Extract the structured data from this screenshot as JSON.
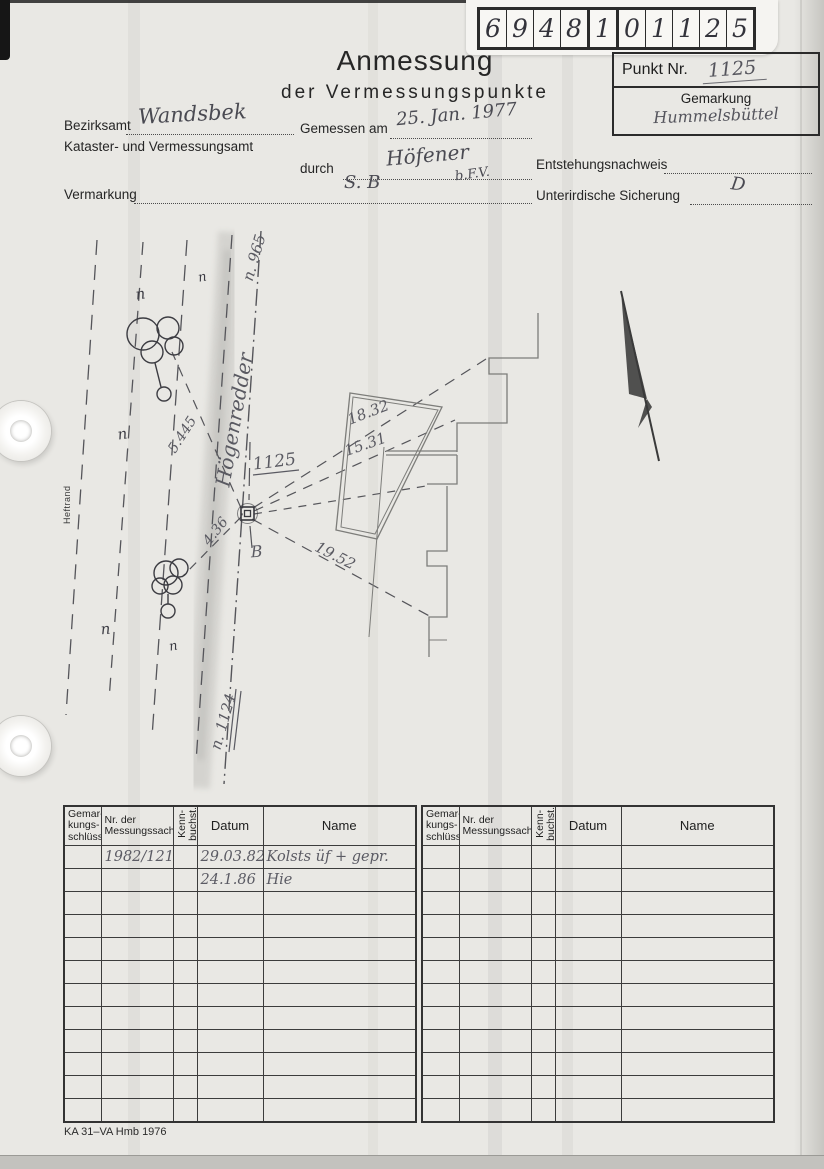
{
  "header": {
    "code_digits": [
      "6",
      "9",
      "4",
      "8",
      "1",
      "0",
      "1",
      "1",
      "2",
      "5"
    ],
    "punkt_label": "Punkt Nr.",
    "punkt_value": "1125",
    "gemarkung_label": "Gemarkung",
    "gemarkung_value": "Hummelsbüttel",
    "title": "Anmessung",
    "subtitle": "der Vermessungspunkte"
  },
  "form": {
    "bezirksamt_label": "Bezirksamt",
    "bezirksamt_value": "Wandsbek",
    "amt_label": "Kataster- und Vermessungsamt",
    "gemessen_label": "Gemessen am",
    "gemessen_value": "25. Jan. 1977",
    "durch_label": "durch",
    "durch_value": "Höfener",
    "durch_value2": "b.F.V.",
    "entstehung_label": "Entstehungsnachweis",
    "vermarkung_label": "Vermarkung",
    "vermarkung_value": "S. B",
    "sicherung_label": "Unterirdische Sicherung",
    "sicherung_value": "D"
  },
  "margin": {
    "heftrand": "Heftrand"
  },
  "sketch": {
    "street_name": "Högenredder",
    "point_number": "1125",
    "labels": [
      {
        "text": "Högenredder",
        "x": 241,
        "y": 421,
        "rot": -80,
        "size": 20,
        "cls": "pencil"
      },
      {
        "text": "n. 965",
        "x": 259,
        "y": 259,
        "rot": -74,
        "size": 15,
        "cls": "pencil"
      },
      {
        "text": "n. 1124",
        "x": 228,
        "y": 723,
        "rot": -74,
        "size": 15,
        "cls": "pencil"
      },
      {
        "text": "1125",
        "x": 275,
        "y": 467,
        "rot": -7,
        "size": 17,
        "cls": "pencil"
      },
      {
        "text": "B",
        "x": 257,
        "y": 557,
        "rot": -4,
        "size": 16,
        "cls": "pencil"
      },
      {
        "text": "5.445",
        "x": 186,
        "y": 437,
        "rot": -57,
        "size": 14,
        "cls": "pencil"
      },
      {
        "text": "4.36",
        "x": 219,
        "y": 534,
        "rot": -52,
        "size": 14,
        "cls": "pencil"
      },
      {
        "text": "19.52",
        "x": 333,
        "y": 560,
        "rot": 27,
        "size": 15,
        "cls": "pencil"
      },
      {
        "text": "18.32",
        "x": 370,
        "y": 417,
        "rot": -21,
        "size": 15,
        "cls": "pencil"
      },
      {
        "text": "15.31",
        "x": 367,
        "y": 449,
        "rot": -19,
        "size": 15,
        "cls": "pencil"
      },
      {
        "text": "n",
        "x": 141,
        "y": 299,
        "rot": -8,
        "size": 15,
        "cls": "pen"
      },
      {
        "text": "n",
        "x": 203,
        "y": 281,
        "rot": -10,
        "size": 13,
        "cls": "pen"
      },
      {
        "text": "n",
        "x": 123,
        "y": 439,
        "rot": -8,
        "size": 15,
        "cls": "pen"
      },
      {
        "text": "n",
        "x": 106,
        "y": 634,
        "rot": -5,
        "size": 15,
        "cls": "pen"
      },
      {
        "text": "n",
        "x": 174,
        "y": 650,
        "rot": -10,
        "size": 13,
        "cls": "pen"
      }
    ]
  },
  "tables": {
    "headers": [
      {
        "label": "Gemar-\nkungs-\nschlüssel",
        "rotated": false
      },
      {
        "label": "Nr. der\nMessungssache",
        "rotated": false
      },
      {
        "label": "Kenn-\nbuchst.",
        "rotated": true
      },
      {
        "label": "Datum",
        "rotated": false
      },
      {
        "label": "Name",
        "rotated": false
      }
    ],
    "left_rows": [
      [
        "",
        "1982/121",
        "",
        "29.03.82",
        "Kolsts üf + gepr."
      ],
      [
        "",
        "",
        "",
        "24.1.86",
        "Hie"
      ],
      [
        "",
        "",
        "",
        "",
        ""
      ],
      [
        "",
        "",
        "",
        "",
        ""
      ],
      [
        "",
        "",
        "",
        "",
        ""
      ],
      [
        "",
        "",
        "",
        "",
        ""
      ],
      [
        "",
        "",
        "",
        "",
        ""
      ],
      [
        "",
        "",
        "",
        "",
        ""
      ],
      [
        "",
        "",
        "",
        "",
        ""
      ],
      [
        "",
        "",
        "",
        "",
        ""
      ],
      [
        "",
        "",
        "",
        "",
        ""
      ],
      [
        "",
        "",
        "",
        "",
        ""
      ]
    ],
    "right_rows": [
      [
        "",
        "",
        "",
        "",
        ""
      ],
      [
        "",
        "",
        "",
        "",
        ""
      ],
      [
        "",
        "",
        "",
        "",
        ""
      ],
      [
        "",
        "",
        "",
        "",
        ""
      ],
      [
        "",
        "",
        "",
        "",
        ""
      ],
      [
        "",
        "",
        "",
        "",
        ""
      ],
      [
        "",
        "",
        "",
        "",
        ""
      ],
      [
        "",
        "",
        "",
        "",
        ""
      ],
      [
        "",
        "",
        "",
        "",
        ""
      ],
      [
        "",
        "",
        "",
        "",
        ""
      ],
      [
        "",
        "",
        "",
        "",
        ""
      ],
      [
        "",
        "",
        "",
        "",
        ""
      ]
    ]
  },
  "footer": {
    "form_code": "KA 31–VA Hmb 1976"
  }
}
